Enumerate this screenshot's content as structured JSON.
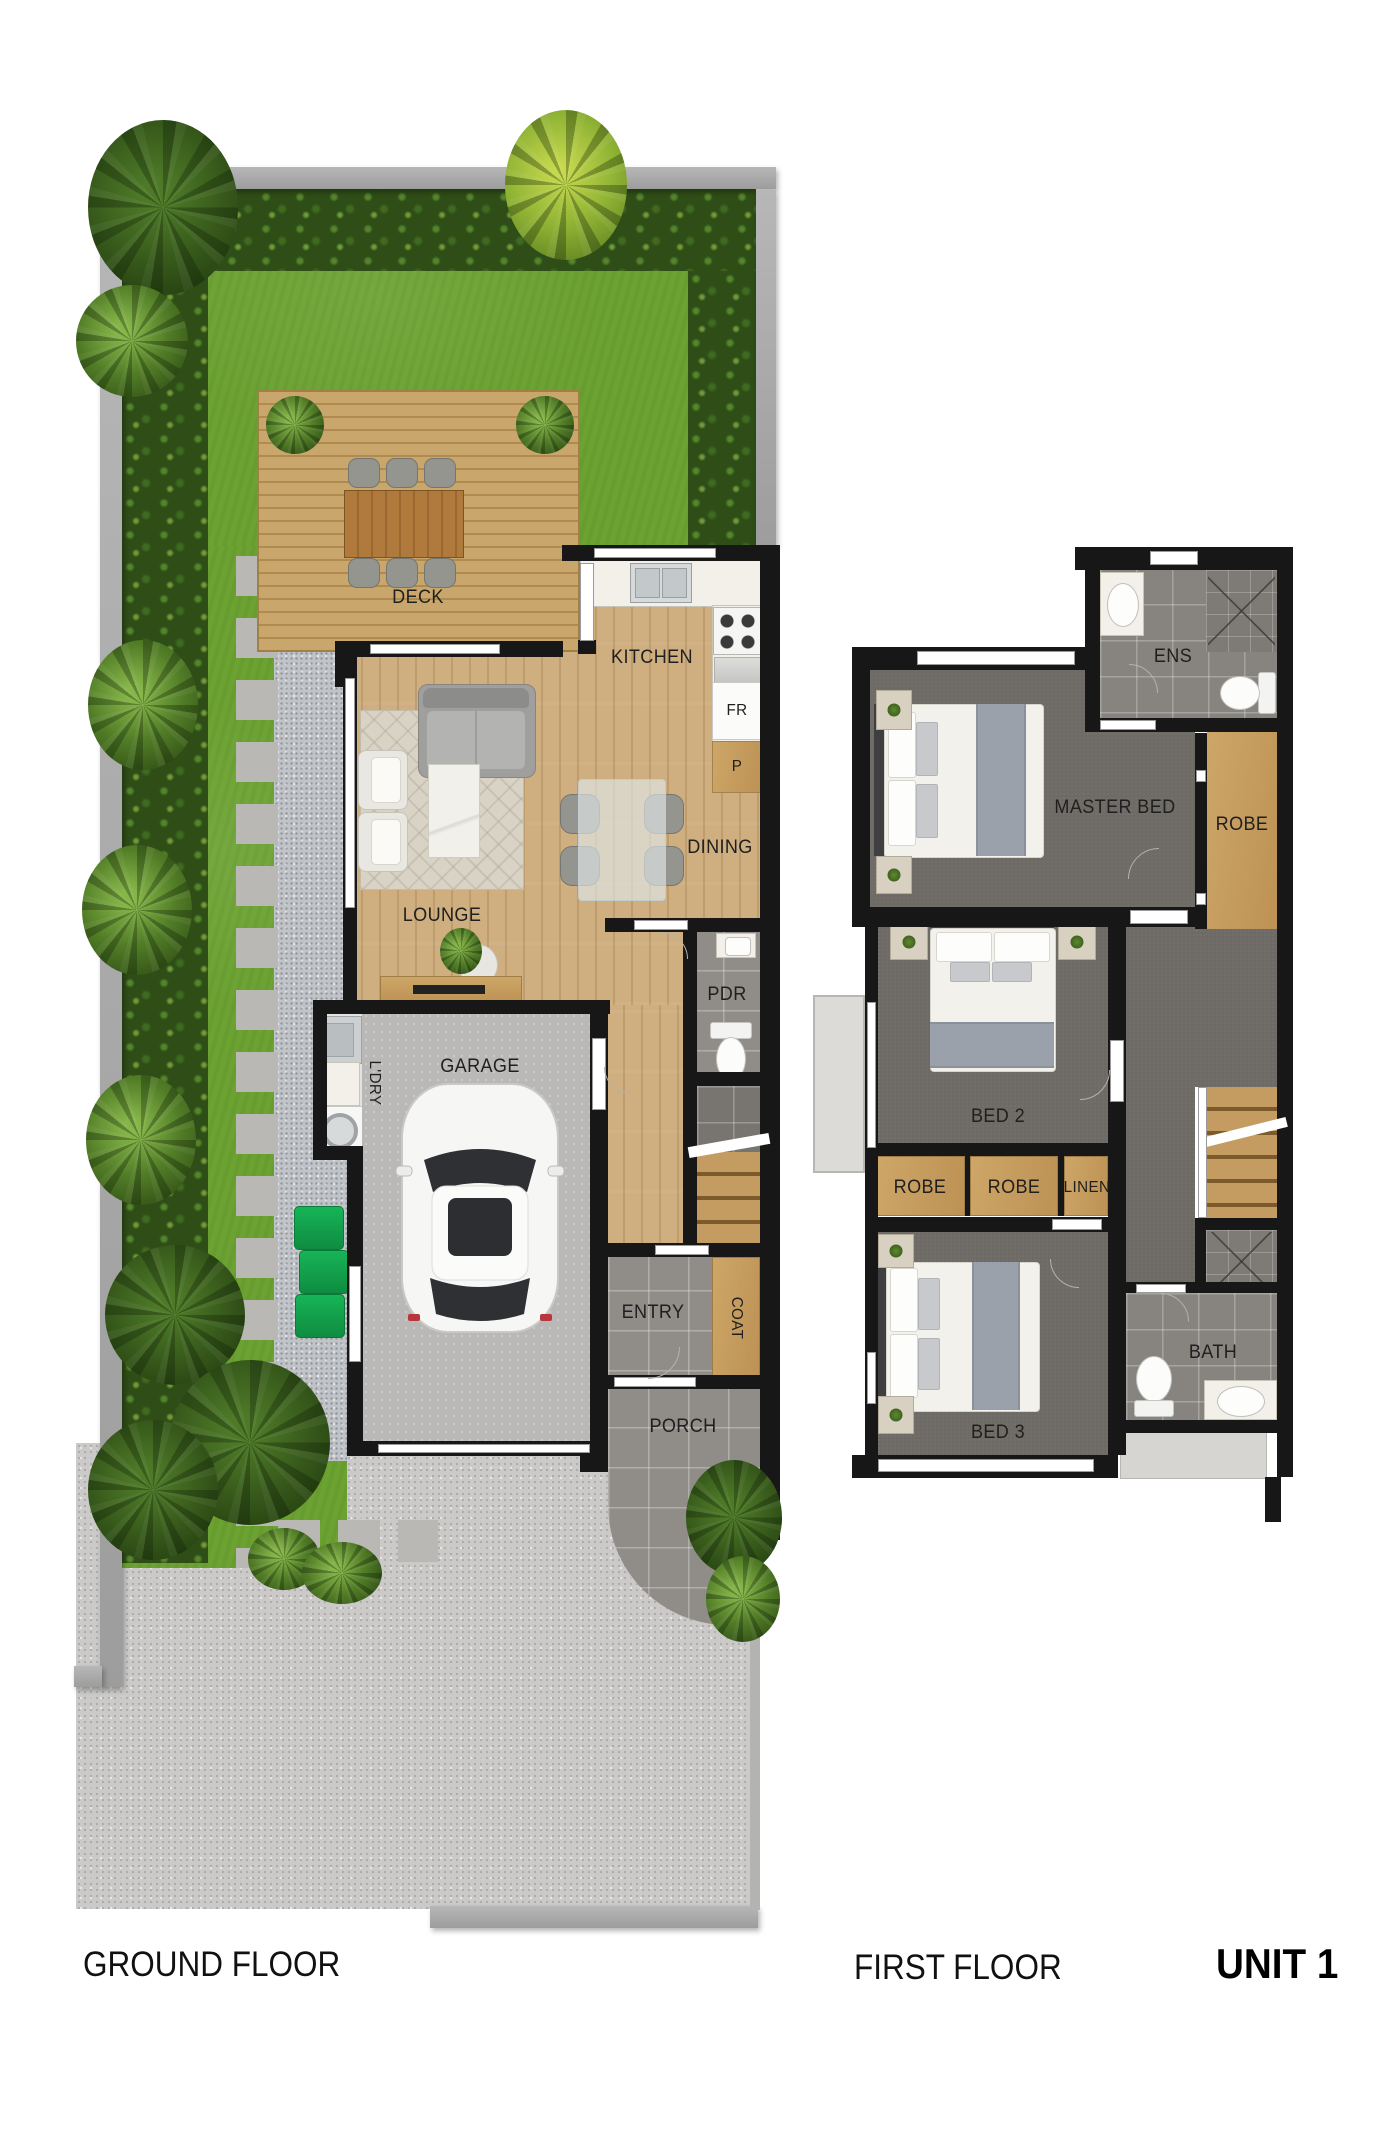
{
  "unit": "UNIT 1",
  "ground": {
    "caption": "GROUND FLOOR",
    "deck": "DECK",
    "kitchen": "KITCHEN",
    "fridge": "FR",
    "pantry": "P",
    "dining": "DINING",
    "lounge": "LOUNGE",
    "garage": "GARAGE",
    "laundry": "L'DRY",
    "powder": "PDR",
    "entry": "ENTRY",
    "coat": "COAT",
    "porch": "PORCH"
  },
  "first": {
    "caption": "FIRST FLOOR",
    "master": "MASTER BED",
    "ensuite": "ENS",
    "master_robe": "ROBE",
    "bed2": "BED 2",
    "robe_a": "ROBE",
    "robe_b": "ROBE",
    "linen": "LINEN",
    "bed3": "BED 3",
    "bath": "BATH"
  },
  "palette": {
    "lawn_green": "#6ba231",
    "hedge_green": "#2e4d17",
    "deck_wood": "#c9a76c",
    "interior_wood": "#cfae80",
    "robe_wood": "#c9a263",
    "carpet_gray": "#6e6a65",
    "tile_gray": "#908d89",
    "wall_black": "#171717",
    "bin_green": "#12a24c",
    "fence_gray": "#a8a8a8"
  }
}
